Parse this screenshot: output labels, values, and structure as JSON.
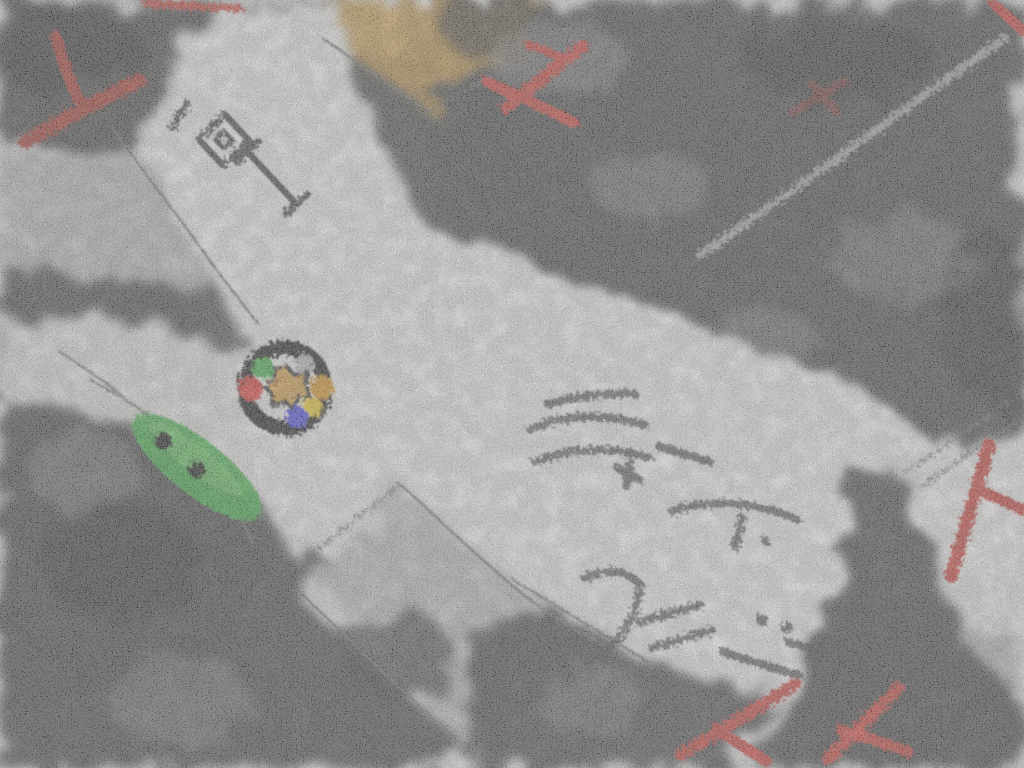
{
  "scene": {
    "type": "hand-drawn map sketch (charcoal / crayon style, bird's-eye street view)",
    "title": ""
  },
  "colors": {
    "paper": "#efeeec",
    "road": "#f6f5f3",
    "roadDim": "#e7e6e3",
    "blockLight": "#b5b5b5",
    "blockMid": "#8f8f8f",
    "charcoal": "#383838",
    "charcoalDeep": "#1f1f1f",
    "pencil": "#6e6e6e",
    "streak": "#d9d9d9",
    "ink": "#3f3f3f",
    "inkDark": "#2c2c2c",
    "building": "#c09040",
    "buildingLight": "#d9ab55",
    "car": "#35b13a",
    "carLight": "#7fd36f",
    "carDot": "#0c0c0c",
    "red": "#cf3a30",
    "redDark": "#a83228",
    "redFaint": "#8d342c",
    "markerRing": "#161616",
    "markerGreen": "#3cb043",
    "markerGray": "#bdbdbd",
    "markerRed": "#d8302c",
    "markerOrange": "#dd941f",
    "markerYellow": "#f4cf25",
    "markerBlue": "#4040dd",
    "markerCenter": "#dfa245",
    "markerOutline": "#2a2a2a"
  },
  "map": {
    "district_label": "1丁目",
    "scribbles": {
      "note_1": "(illegible handwritten scribble along road)",
      "note_2": "(illegible handwritten scribble along road)"
    },
    "marker": {
      "kind": "intersection marker ring with colored dots and tan center blob",
      "dot_colors": [
        "#3cb043",
        "#bdbdbd",
        "#d8302c",
        "#dd941f",
        "#f4cf25",
        "#4040dd"
      ]
    },
    "vehicle": {
      "kind": "green vehicle with two dark dots",
      "location": "west road"
    },
    "building_highlight": {
      "kind": "tan landmark building",
      "location": "top center"
    },
    "red_marks": [
      {
        "shape": "check stroke",
        "location": "top-left"
      },
      {
        "shape": "streak",
        "location": "top edge"
      },
      {
        "shape": "airplane",
        "location": "top center"
      },
      {
        "shape": "faint x scribble",
        "location": "upper right"
      },
      {
        "shape": "corner streak",
        "location": "top-right corner"
      },
      {
        "shape": "t-stroke",
        "location": "right edge"
      },
      {
        "shape": "x mark",
        "location": "bottom center-right"
      },
      {
        "shape": "x mark",
        "location": "bottom right"
      }
    ]
  }
}
